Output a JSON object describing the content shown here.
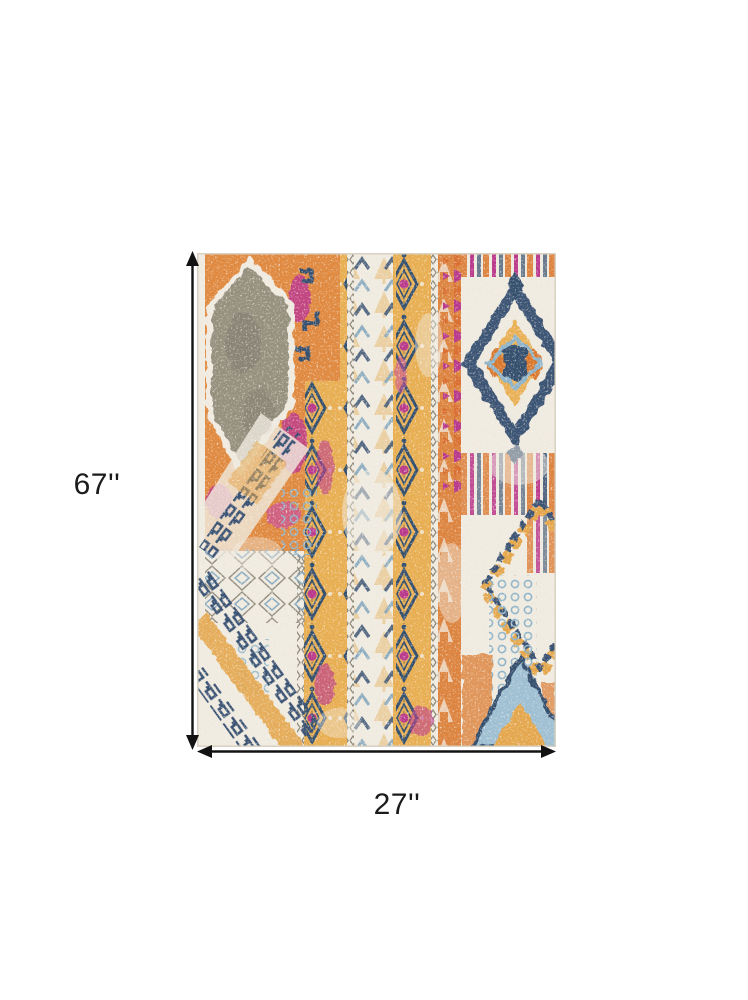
{
  "window": {
    "background": "#ffffff",
    "width": 748,
    "height": 1000
  },
  "diagram": {
    "type": "product-dimension-image",
    "product": "Multicolor distressed bohemian tribal area rug",
    "height_label": "67''",
    "width_label": "27''",
    "arrow_color": "#121212",
    "label_color": "#1b1b1b"
  },
  "rug": {
    "description": "Vintage-style southwestern rug with vertical motif stripes, gray lozenge panel at top left, navy and gold diamond medallions on the right, Greek-key diagonal bands at bottom left, heavy ivory distressing",
    "palette": {
      "ivory": "#F0EBE0",
      "orange": "#DC8440",
      "saffron": "#E8AE52",
      "magenta": "#B93A8C",
      "pink": "#D96AA6",
      "navy": "#3A5273",
      "sky_blue": "#8FB4C9",
      "gray": "#95907F"
    }
  }
}
